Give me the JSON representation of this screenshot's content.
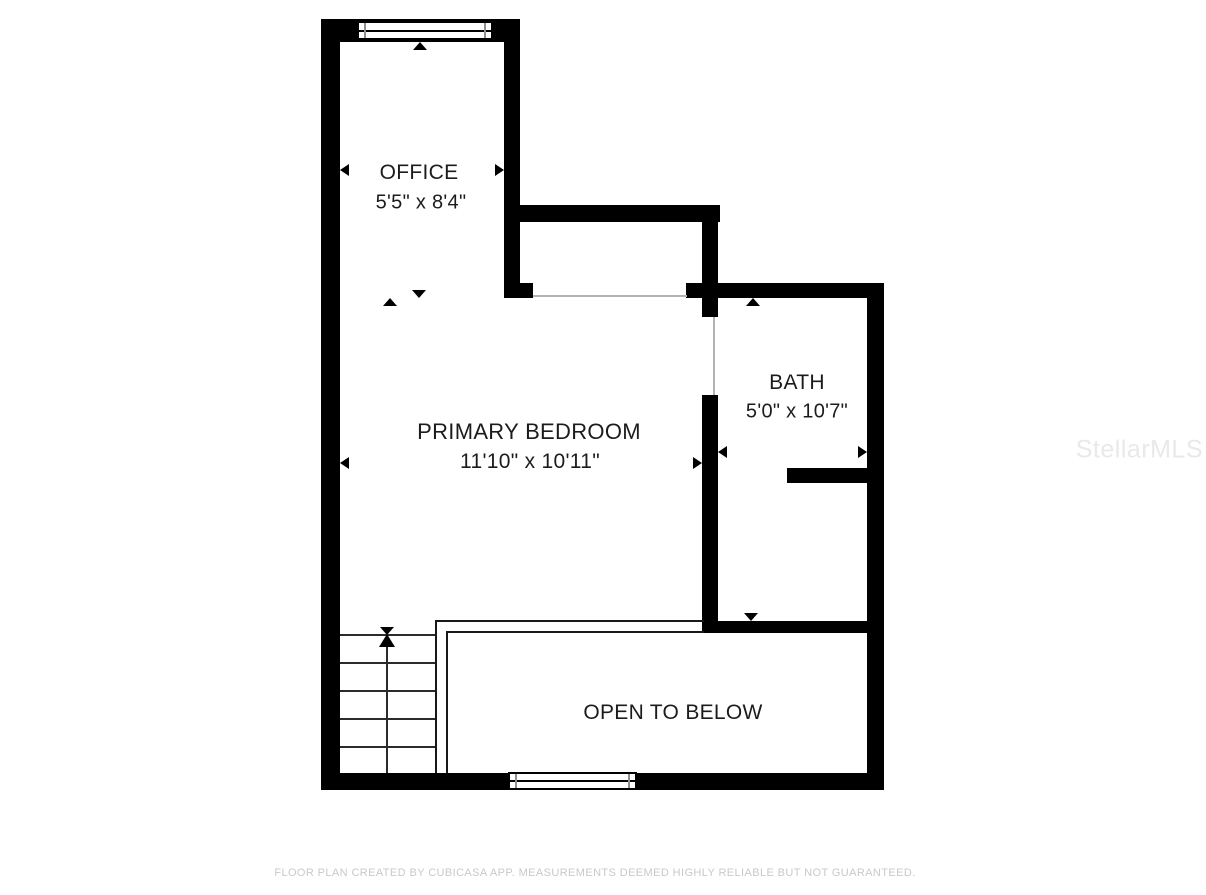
{
  "rooms": [
    {
      "id": "office",
      "name": "OFFICE",
      "dimensions": "5'5\" x 8'4\""
    },
    {
      "id": "primary-bedroom",
      "name": "PRIMARY BEDROOM",
      "dimensions": "11'10\" x 10'11\""
    },
    {
      "id": "bath",
      "name": "BATH",
      "dimensions": "5'0\" x 10'7\""
    },
    {
      "id": "open-to-below",
      "name": "OPEN TO BELOW"
    }
  ],
  "footer": {
    "disclaimer": "FLOOR PLAN CREATED BY CUBICASA APP. MEASUREMENTS DEEMED HIGHLY RELIABLE BUT NOT GUARANTEED."
  },
  "watermark": {
    "text": "StellarMLS"
  },
  "colors": {
    "wall": "#000000",
    "room_label": "#1c1c1c",
    "opening_line": "#b3b3b3",
    "footer_text": "#c7c9cc",
    "watermark_text": "#e9e9eb",
    "background": "#ffffff"
  }
}
